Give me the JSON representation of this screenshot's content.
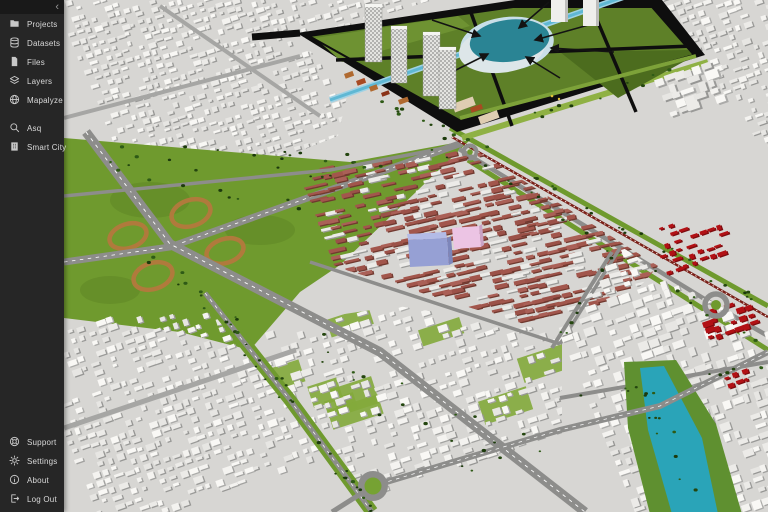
{
  "app": {
    "name": "Mapalyze",
    "view": "3D city model viewport"
  },
  "sidebar": {
    "collapse_label": "‹",
    "items": [
      {
        "id": "projects",
        "label": "Projects",
        "icon": "folder-icon"
      },
      {
        "id": "datasets",
        "label": "Datasets",
        "icon": "database-icon"
      },
      {
        "id": "files",
        "label": "Files",
        "icon": "file-icon"
      },
      {
        "id": "layers",
        "label": "Layers",
        "icon": "layers-icon"
      },
      {
        "id": "mapalyze",
        "label": "Mapalyze",
        "icon": "globe-icon"
      }
    ],
    "tools": [
      {
        "id": "asq",
        "label": "Asq",
        "icon": "search-icon"
      },
      {
        "id": "smart-city",
        "label": "Smart City",
        "icon": "building-icon"
      }
    ],
    "footer": [
      {
        "id": "support",
        "label": "Support",
        "icon": "lifebuoy-icon"
      },
      {
        "id": "settings",
        "label": "Settings",
        "icon": "gear-icon"
      },
      {
        "id": "about",
        "label": "About",
        "icon": "info-icon"
      },
      {
        "id": "logout",
        "label": "Log Out",
        "icon": "logout-icon"
      }
    ]
  },
  "map": {
    "type": "3d-city-model",
    "colors": {
      "ground": "#d7d6d3",
      "black": "#0e0e0e",
      "parkGreen": "#5e8028",
      "parkGreenL": "#6e9232",
      "parkGreenD": "#4c6c1e",
      "lawn": "#83aa3b",
      "avenue": "#6f9a2e",
      "slope": "#8fb144",
      "pathLight": "#7da239",
      "pondWater": "#2a8494",
      "pondRim": "#c9dfe8",
      "pondShore": "#dde6e9",
      "canal": "#9fd2e4",
      "canalCore": "#5fb8d4",
      "river": "#2aa4b8",
      "bank": "#5f9030",
      "loop": "#b07a3c",
      "roadGray": "#8d8d8b",
      "roadLight": "#a6a6a4",
      "roseRoof": "#a2564c",
      "roseRoof2": "#aa6057",
      "roseRoof3": "#9b5148",
      "roseShadow": "#71392f",
      "red": "#b21115",
      "redDark": "#7c0b0e",
      "rail": "#7a2018",
      "periwinkle": "#96a0d4",
      "periSide": "#7d86ba",
      "pinkSel": "#ecc4e4",
      "pinkSide": "#c9a2c4",
      "tree1": "#24460f",
      "tree2": "#2e5a16",
      "tree3": "#1c3a0c",
      "orange": "#b06a30",
      "rust": "#a84a22",
      "beige": "#dfcdb2",
      "towerSide": "#bdbdbb"
    }
  }
}
